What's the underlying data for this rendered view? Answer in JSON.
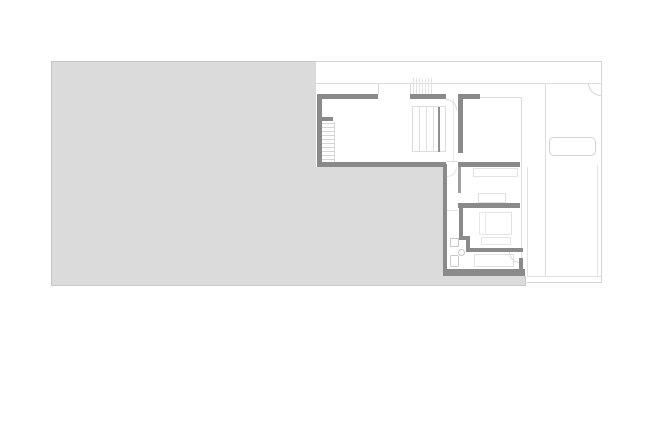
{
  "canvas": {
    "width": 652,
    "height": 435,
    "background": "#ffffff"
  },
  "palette": {
    "terrace_fill": "#dbdbdb",
    "terrace_border": "#c6c6c6",
    "wall": "#8a8a8a",
    "wall_light": "#a0a0a0",
    "site_line": "#d4d4d4",
    "thin_line": "#dcdcdc",
    "faint_line": "#e6e6e6",
    "fixture_line": "#c9c9c9",
    "furniture_line": "#e2e2e2"
  },
  "shapes": [
    {
      "name": "terrace-area",
      "type": "rect",
      "x": 51,
      "y": 61,
      "w": 475,
      "h": 225,
      "fill": "#dbdbdb",
      "stroke": "#c6c6c6"
    },
    {
      "name": "house-top-band",
      "type": "rect",
      "x": 316,
      "y": 62,
      "w": 286,
      "h": 105,
      "fill": "#ffffff"
    },
    {
      "name": "house-bedroom-column",
      "type": "rect",
      "x": 443,
      "y": 167,
      "w": 84,
      "h": 109,
      "fill": "#ffffff"
    },
    {
      "name": "driveway-area",
      "type": "rect",
      "x": 527,
      "y": 62,
      "w": 75,
      "h": 221,
      "fill": "#ffffff"
    },
    {
      "name": "site-boundary-top",
      "type": "hline",
      "x": 316,
      "y": 61,
      "w": 286,
      "color": "#d4d4d4"
    },
    {
      "name": "site-boundary-right",
      "type": "vline",
      "x": 601,
      "y": 61,
      "h": 222,
      "color": "#d4d4d4"
    },
    {
      "name": "site-boundary-bottom",
      "type": "hline",
      "x": 527,
      "y": 282,
      "w": 75,
      "color": "#d4d4d4"
    },
    {
      "name": "slab-edge-bottom",
      "type": "hline",
      "x": 527,
      "y": 276,
      "w": 74,
      "color": "#e0e0e0"
    },
    {
      "name": "floor-below-outline",
      "type": "hline",
      "x": 316,
      "y": 83,
      "w": 286,
      "color": "#dcdcdc"
    },
    {
      "name": "walkway-line",
      "type": "vline",
      "x": 545,
      "y": 83,
      "h": 193,
      "color": "#dcdcdc"
    },
    {
      "name": "house-right-edge-line",
      "type": "vline",
      "x": 597,
      "y": 165,
      "h": 111,
      "color": "#e6e6e6"
    },
    {
      "name": "driveway-left-edge",
      "type": "vline",
      "x": 527,
      "y": 167,
      "h": 109,
      "color": "#e3e3e3"
    },
    {
      "name": "window-tick-left",
      "type": "vline",
      "x": 378,
      "y": 84,
      "h": 10,
      "color": "#d8d8d8"
    },
    {
      "name": "window-tick-right",
      "type": "vline",
      "x": 410,
      "y": 84,
      "h": 10,
      "color": "#d8d8d8"
    },
    {
      "name": "skylight-hatch",
      "type": "hatch-v",
      "x": 413,
      "y": 78,
      "h": 16,
      "count": 7,
      "step": 3,
      "color": "#e2e2e2"
    },
    {
      "name": "hall-edge-line",
      "type": "vline",
      "x": 453,
      "y": 99,
      "h": 63,
      "color": "#e7e7e7"
    },
    {
      "name": "room-tr-outline-top",
      "type": "hline",
      "x": 480,
      "y": 97,
      "w": 41,
      "color": "#dcdcdc"
    },
    {
      "name": "room-tr-outline-right",
      "type": "vline",
      "x": 521,
      "y": 97,
      "h": 163,
      "color": "#dcdcdc"
    },
    {
      "name": "hall-threshold-line",
      "type": "hline",
      "x": 447,
      "y": 161,
      "w": 11,
      "color": "#e0e0e0"
    },
    {
      "name": "hall-door-line",
      "type": "hline",
      "x": 447,
      "y": 210,
      "w": 11,
      "color": "#e5e5e5"
    },
    {
      "name": "stair-left-treads",
      "type": "hatch-h",
      "x": 322,
      "y": 123,
      "w": 12,
      "count": 10,
      "step": 4,
      "color": "#d6d6d6"
    },
    {
      "name": "stair-left-edge",
      "type": "vline",
      "x": 334,
      "y": 122,
      "h": 40,
      "color": "#d6d6d6"
    },
    {
      "name": "stair-mid-box",
      "type": "rect",
      "x": 412,
      "y": 106,
      "w": 34,
      "h": 46,
      "stroke": "#dcdcdc"
    },
    {
      "name": "stair-mid-tread-1",
      "type": "vline",
      "x": 419,
      "y": 107,
      "h": 44,
      "color": "#dedede"
    },
    {
      "name": "stair-mid-tread-2",
      "type": "vline",
      "x": 426,
      "y": 107,
      "h": 44,
      "color": "#dedede"
    },
    {
      "name": "stair-mid-tread-3",
      "type": "vline",
      "x": 433,
      "y": 107,
      "h": 44,
      "color": "#dedede"
    },
    {
      "name": "wardrobe-room-1",
      "type": "rect",
      "x": 473,
      "y": 168,
      "w": 45,
      "h": 9,
      "fill": "#ffffff",
      "stroke": "#e2e2e2"
    },
    {
      "name": "bed-room-1",
      "type": "rect",
      "x": 478,
      "y": 193,
      "w": 28,
      "h": 10,
      "fill": "#ffffff",
      "stroke": "#e2e2e2"
    },
    {
      "name": "bed-room-2",
      "type": "rect",
      "x": 479,
      "y": 212,
      "w": 33,
      "h": 23,
      "fill": "#ffffff",
      "stroke": "#e2e2e2"
    },
    {
      "name": "pillow-room-2",
      "type": "rect",
      "x": 479,
      "y": 212,
      "w": 7,
      "h": 23,
      "stroke": "#e8e8e8"
    },
    {
      "name": "bench-room-2",
      "type": "rect",
      "x": 481,
      "y": 237,
      "w": 30,
      "h": 8,
      "fill": "#ffffff",
      "stroke": "#e5e5e5"
    },
    {
      "name": "bed-room-3",
      "type": "rect",
      "x": 474,
      "y": 254,
      "w": 40,
      "h": 13,
      "fill": "#ffffff",
      "stroke": "#e2e2e2"
    },
    {
      "name": "car-outline",
      "type": "rect",
      "x": 549,
      "y": 137,
      "w": 47,
      "h": 19,
      "fill": "#ffffff",
      "stroke": "#d4d4d4",
      "r": 5
    },
    {
      "name": "bath-vanity",
      "type": "rect",
      "x": 450,
      "y": 238,
      "w": 9,
      "h": 9,
      "fill": "#ffffff",
      "stroke": "#c9c9c9"
    },
    {
      "name": "bath-sink",
      "type": "circle",
      "x": 458,
      "y": 249,
      "w": 7,
      "h": 7,
      "stroke": "#c9c9c9"
    },
    {
      "name": "bath-toilet",
      "type": "rect",
      "x": 450,
      "y": 255,
      "w": 9,
      "h": 12,
      "fill": "#ffffff",
      "stroke": "#c9c9c9",
      "r": 2
    },
    {
      "name": "gate-swing-arc",
      "type": "arc",
      "x": 588,
      "y": 83,
      "w": 13,
      "h": 13,
      "corner": "bl",
      "color": "#d4d4d4"
    },
    {
      "name": "stair-top-door-arc",
      "type": "arc",
      "x": 446,
      "y": 99,
      "w": 11,
      "h": 11,
      "corner": "tr",
      "color": "#d8d8d8"
    },
    {
      "name": "hall-door-arc",
      "type": "arc",
      "x": 447,
      "y": 167,
      "w": 10,
      "h": 10,
      "corner": "br",
      "color": "#e6e6e6"
    },
    {
      "name": "room-3-door-arc",
      "type": "arc",
      "x": 509,
      "y": 252,
      "w": 11,
      "h": 11,
      "corner": "bl",
      "color": "#dadada"
    },
    {
      "name": "wall-top-a",
      "type": "rect",
      "x": 317,
      "y": 94,
      "w": 61,
      "h": 5,
      "fill": "#8a8a8a"
    },
    {
      "name": "wall-left",
      "type": "rect",
      "x": 317,
      "y": 94,
      "w": 5,
      "h": 73,
      "fill": "#8a8a8a"
    },
    {
      "name": "wall-stair-stub",
      "type": "rect",
      "x": 317,
      "y": 117,
      "w": 16,
      "h": 4,
      "fill": "#8a8a8a"
    },
    {
      "name": "wall-top-b",
      "type": "rect",
      "x": 410,
      "y": 94,
      "w": 36,
      "h": 5,
      "fill": "#8a8a8a"
    },
    {
      "name": "wall-top-c",
      "type": "rect",
      "x": 458,
      "y": 94,
      "w": 22,
      "h": 5,
      "fill": "#8a8a8a"
    },
    {
      "name": "wall-right-col-upper",
      "type": "rect",
      "x": 458,
      "y": 94,
      "w": 5,
      "h": 59,
      "fill": "#8a8a8a"
    },
    {
      "name": "wall-row-bottom-left",
      "type": "rect",
      "x": 317,
      "y": 162,
      "w": 129,
      "h": 5,
      "fill": "#8a8a8a"
    },
    {
      "name": "wall-row-bottom-right",
      "type": "rect",
      "x": 458,
      "y": 162,
      "w": 62,
      "h": 5,
      "fill": "#8a8a8a"
    },
    {
      "name": "wall-bedcol-left",
      "type": "rect",
      "x": 443,
      "y": 164,
      "w": 4,
      "h": 112,
      "fill": "#8a8a8a"
    },
    {
      "name": "wall-mid-bedrooms",
      "type": "rect",
      "x": 458,
      "y": 203,
      "w": 62,
      "h": 5,
      "fill": "#8a8a8a"
    },
    {
      "name": "wall-hall-vertical",
      "type": "rect",
      "x": 459,
      "y": 208,
      "w": 4,
      "h": 32,
      "fill": "#8a8a8a"
    },
    {
      "name": "wall-bath-jog-h",
      "type": "rect",
      "x": 459,
      "y": 236,
      "w": 11,
      "h": 4,
      "fill": "#8a8a8a"
    },
    {
      "name": "wall-bath-jog-v",
      "type": "rect",
      "x": 466,
      "y": 240,
      "w": 4,
      "h": 12,
      "fill": "#8a8a8a"
    },
    {
      "name": "wall-room-3-top",
      "type": "rect",
      "x": 466,
      "y": 248,
      "w": 57,
      "h": 4,
      "fill": "#8a8a8a"
    },
    {
      "name": "wall-door-stub",
      "type": "rect",
      "x": 519,
      "y": 258,
      "w": 4,
      "h": 11,
      "fill": "#8a8a8a"
    },
    {
      "name": "wall-bottom",
      "type": "rect",
      "x": 443,
      "y": 269,
      "w": 82,
      "h": 7,
      "fill": "#8a8a8a"
    },
    {
      "name": "stair-mid-rail",
      "type": "rect",
      "x": 438,
      "y": 107,
      "w": 2,
      "h": 45,
      "fill": "#8f8f8f"
    },
    {
      "name": "wall-hall-lower",
      "type": "rect",
      "x": 458,
      "y": 167,
      "w": 3,
      "h": 26,
      "fill": "#a0a0a0"
    }
  ]
}
